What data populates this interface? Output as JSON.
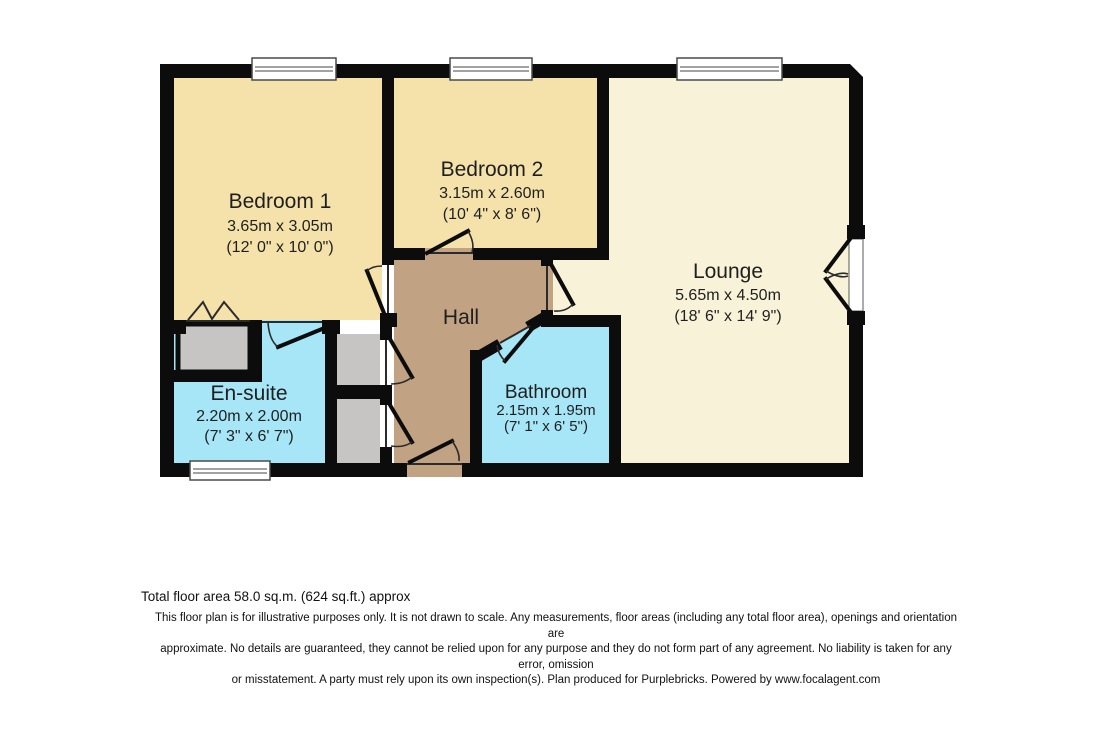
{
  "rooms": {
    "bedroom1": {
      "name": "Bedroom 1",
      "metric": "3.65m x 3.05m",
      "imperial": "(12' 0\" x 10' 0\")"
    },
    "bedroom2": {
      "name": "Bedroom 2",
      "metric": "3.15m x 2.60m",
      "imperial": "(10' 4\" x 8' 6\")"
    },
    "lounge": {
      "name": "Lounge",
      "metric": "5.65m x 4.50m",
      "imperial": "(18' 6\" x 14' 9\")"
    },
    "ensuite": {
      "name": "En-suite",
      "metric": "2.20m x 2.00m",
      "imperial": "(7' 3\" x 6' 7\")"
    },
    "bathroom": {
      "name": "Bathroom",
      "metric": "2.15m x 1.95m",
      "imperial": "(7' 1\" x 6' 5\")"
    },
    "hall": {
      "name": "Hall"
    }
  },
  "footer": {
    "total_area": "Total floor area 58.0 sq.m. (624 sq.ft.) approx",
    "disclaimer_line1": "This floor plan is for illustrative purposes only. It is not drawn to scale. Any measurements, floor areas (including any total floor area), openings and orientation are",
    "disclaimer_line2": "approximate. No details are guaranteed, they cannot be relied upon for any purpose and they do not form part of any agreement. No liability is taken for any error, omission",
    "disclaimer_line3": "or misstatement. A party must rely upon its own inspection(s). Plan produced for Purplebricks. Powered by www.focalagent.com"
  },
  "colors": {
    "wall": "#0c0c0c",
    "bedroom_floor": "#f5e2ab",
    "lounge_floor": "#f8f2d8",
    "hall_floor": "#c1a282",
    "wet_room_floor": "#a6e6f7",
    "cupboard": "#c7c5c3",
    "window": "#ffffff"
  }
}
